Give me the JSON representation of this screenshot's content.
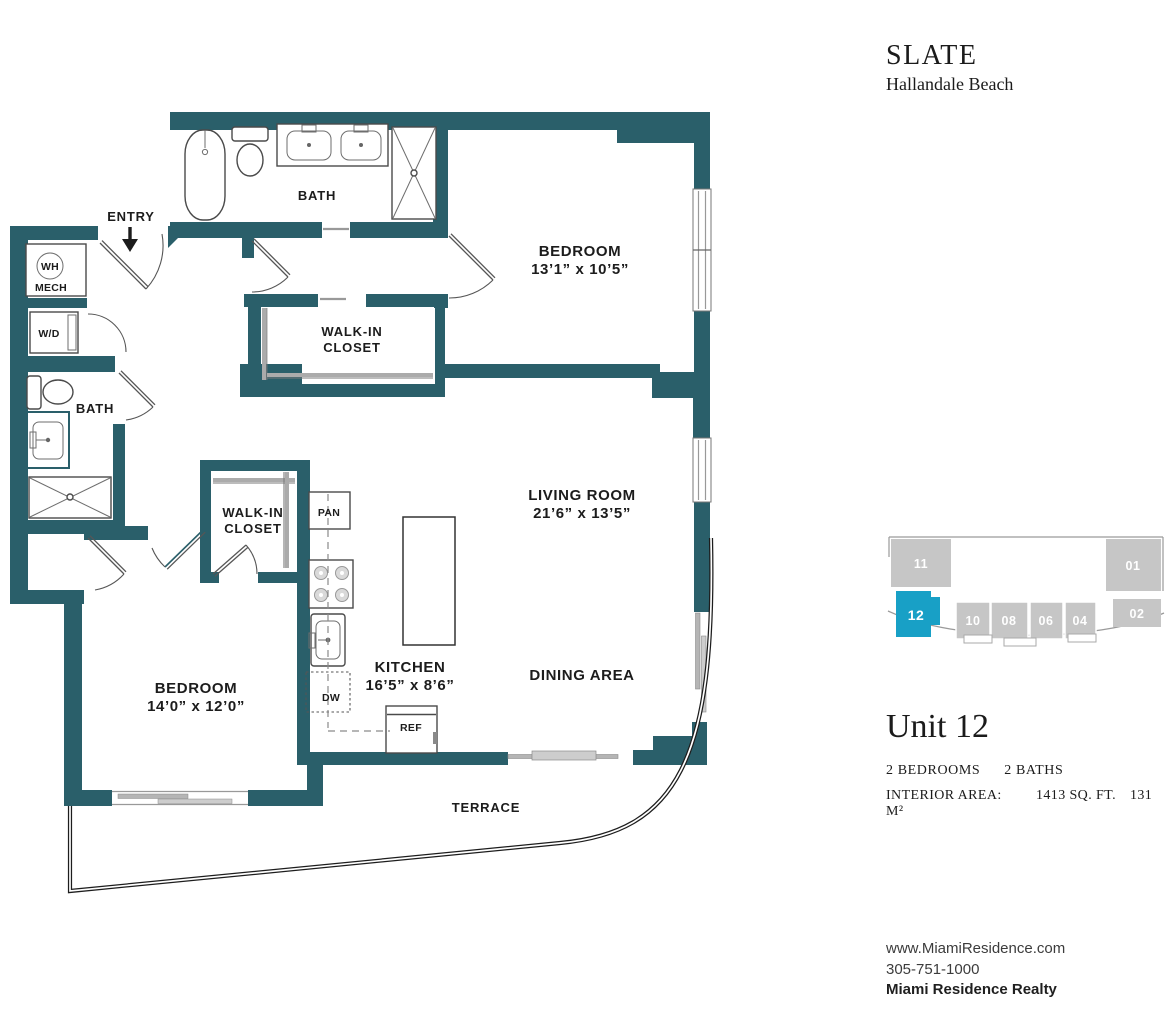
{
  "branding": {
    "title": "SLATE",
    "subtitle": "Hallandale Beach"
  },
  "unit": {
    "name": "Unit 12",
    "bedrooms": "2 BEDROOMS",
    "baths": "2 BATHS",
    "interior_area_label": "INTERIOR AREA:",
    "area_sqft": "1413 SQ. FT.",
    "area_sqm": "131 M²"
  },
  "contact": {
    "website": "www.MiamiResidence.com",
    "phone": "305-751-1000",
    "company": "Miami Residence Realty"
  },
  "key_plan": {
    "highlighted_unit": "12",
    "highlight_color": "#18a0c6",
    "unit_color": "#c6c6c6",
    "units": [
      {
        "label": "11"
      },
      {
        "label": "01"
      },
      {
        "label": "12"
      },
      {
        "label": "10"
      },
      {
        "label": "08"
      },
      {
        "label": "06"
      },
      {
        "label": "04"
      },
      {
        "label": "02"
      }
    ]
  },
  "floor_plan": {
    "wall_color": "#2a5f6a",
    "labels": {
      "entry": "ENTRY",
      "bath_upper": "BATH",
      "bath_lower": "BATH",
      "bedroom_upper": {
        "name": "BEDROOM",
        "dims": "13’1” x 10’5”"
      },
      "bedroom_lower": {
        "name": "BEDROOM",
        "dims": "14’0” x 12’0”"
      },
      "closet_upper": {
        "line1": "WALK-IN",
        "line2": "CLOSET"
      },
      "closet_lower": {
        "line1": "WALK-IN",
        "line2": "CLOSET"
      },
      "living": {
        "name": "LIVING ROOM",
        "dims": "21’6” x 13’5”"
      },
      "dining": "DINING AREA",
      "kitchen": {
        "name": "KITCHEN",
        "dims": "16’5” x 8’6”"
      },
      "terrace": "TERRACE"
    },
    "fixtures": {
      "water_heater": "WH",
      "mech": "MECH",
      "washer_dryer": "W/D",
      "pantry": "PAN",
      "dishwasher": "DW",
      "refrigerator": "REF"
    }
  }
}
